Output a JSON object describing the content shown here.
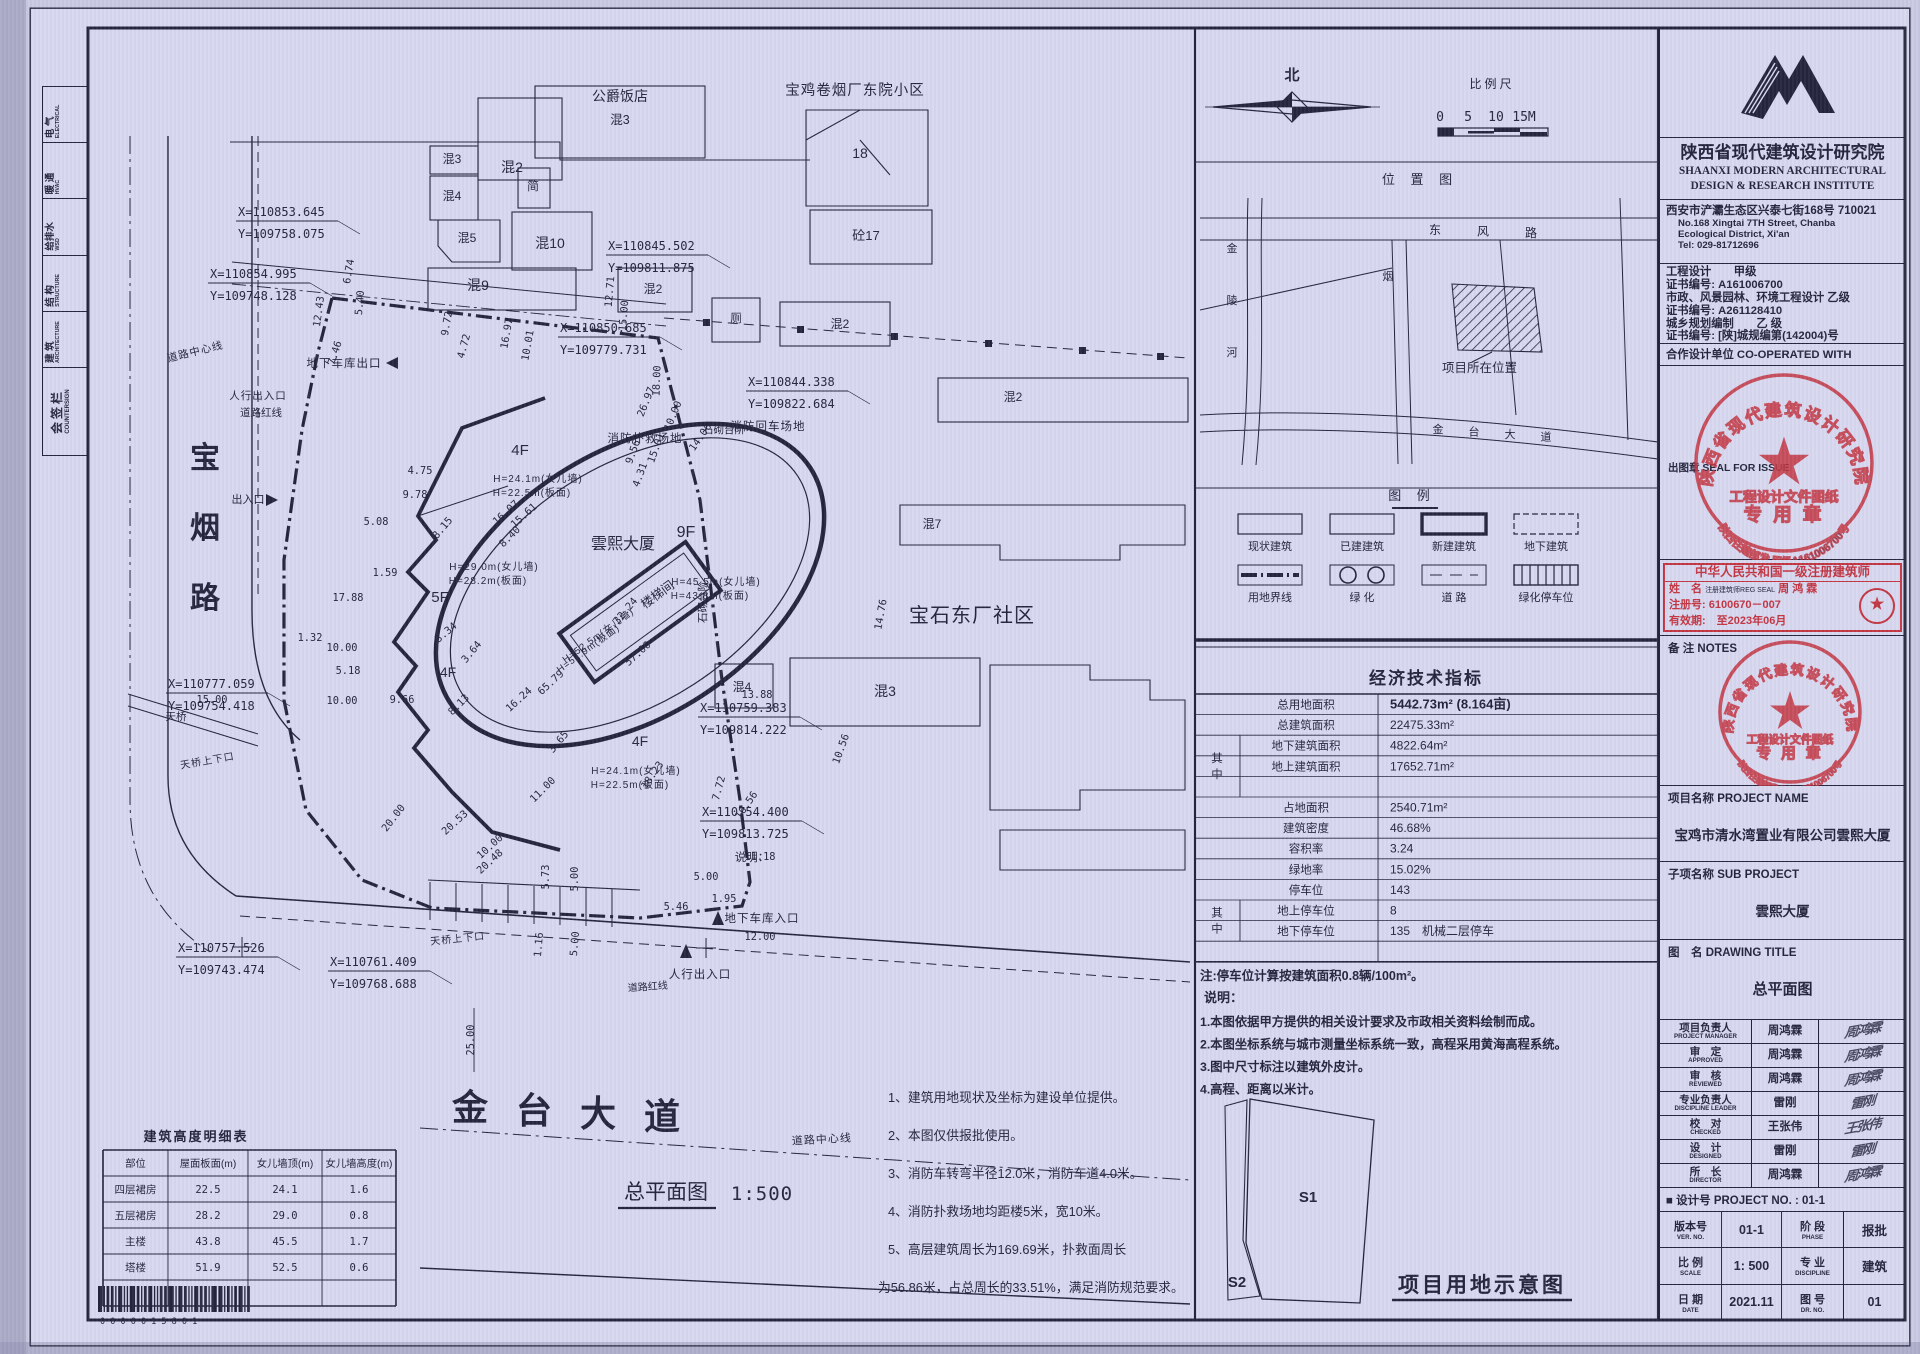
{
  "colors": {
    "paper": "#d7d7ef",
    "ink": "#23233a",
    "stamp_red": "#c23440"
  },
  "countersign": {
    "title_cn": "会签栏",
    "title_en": "COUNTERSIGN",
    "disciplines": [
      {
        "cn": "建 筑",
        "en": "ARCHITECTURE"
      },
      {
        "cn": "结 构",
        "en": "STRUCTURE"
      },
      {
        "cn": "给排水",
        "en": "WSD"
      },
      {
        "cn": "暖 通",
        "en": "HVAC"
      },
      {
        "cn": "电 气",
        "en": "ELECTRICAL"
      }
    ]
  },
  "site_plan": {
    "drawing_title": "总平面图",
    "drawing_scale": "1:500",
    "barcode": "0 0 0 0 0 1 5 8 0 1",
    "labels": [
      {
        "t": "公爵饭店",
        "x": 620,
        "y": 101,
        "s": 14
      },
      {
        "t": "混3",
        "x": 620,
        "y": 124,
        "s": 12.5
      },
      {
        "t": "宝鸡卷烟厂东院小区",
        "x": 855,
        "y": 95,
        "s": 14.5
      },
      {
        "t": "混3",
        "x": 452,
        "y": 163,
        "s": 12
      },
      {
        "t": "混2",
        "x": 512,
        "y": 172,
        "s": 14
      },
      {
        "t": "简",
        "x": 533,
        "y": 190,
        "s": 12
      },
      {
        "t": "混4",
        "x": 452,
        "y": 200,
        "s": 12
      },
      {
        "t": "混5",
        "x": 467,
        "y": 242,
        "s": 12
      },
      {
        "t": "混10",
        "x": 550,
        "y": 248,
        "s": 14
      },
      {
        "t": "混9",
        "x": 478,
        "y": 290,
        "s": 14
      },
      {
        "t": "混2",
        "x": 653,
        "y": 293,
        "s": 12
      },
      {
        "t": "18",
        "x": 860,
        "y": 158,
        "s": 14
      },
      {
        "t": "砼17",
        "x": 866,
        "y": 240,
        "s": 13
      },
      {
        "t": "厕",
        "x": 736,
        "y": 322,
        "s": 11.5
      },
      {
        "t": "混2",
        "x": 840,
        "y": 328,
        "s": 12
      },
      {
        "t": "混2",
        "x": 1013,
        "y": 401,
        "s": 12
      },
      {
        "t": "混7",
        "x": 932,
        "y": 528,
        "s": 12
      },
      {
        "t": "宝石东厂社区",
        "x": 972,
        "y": 622,
        "s": 20
      },
      {
        "t": "混3",
        "x": 885,
        "y": 696,
        "s": 14
      },
      {
        "t": "混4",
        "x": 742,
        "y": 691,
        "s": 12
      },
      {
        "t": "石砌台阶",
        "x": 724,
        "y": 433,
        "s": 10.5
      },
      {
        "t": "石砌台阶",
        "x": 706,
        "y": 602,
        "s": 10.5,
        "r": -90
      },
      {
        "t": "雲熙大厦",
        "x": 623,
        "y": 549,
        "s": 16
      },
      {
        "t": "9F",
        "x": 686,
        "y": 537,
        "s": 16
      },
      {
        "t": "4F",
        "x": 520,
        "y": 455,
        "s": 15
      },
      {
        "t": "5F",
        "x": 440,
        "y": 602,
        "s": 15
      },
      {
        "t": "4F",
        "x": 448,
        "y": 677,
        "s": 14
      },
      {
        "t": "4F",
        "x": 640,
        "y": 746,
        "s": 14
      },
      {
        "t": "楼梯间",
        "x": 660,
        "y": 598,
        "s": 12.5,
        "r": -36
      },
      {
        "t": "H=24.1m(女儿墙)",
        "x": 538,
        "y": 482,
        "s": 10
      },
      {
        "t": "H=22.5m(板面)",
        "x": 532,
        "y": 496,
        "s": 10
      },
      {
        "t": "H=29.0m(女儿墙)",
        "x": 494,
        "y": 570,
        "s": 10
      },
      {
        "t": "H=28.2m(板面)",
        "x": 488,
        "y": 584,
        "s": 10
      },
      {
        "t": "H=45.5m(女儿墙)",
        "x": 716,
        "y": 585,
        "s": 10
      },
      {
        "t": "H=43.8m(板面)",
        "x": 710,
        "y": 599,
        "s": 10
      },
      {
        "t": "H=52.5m(女儿墙)",
        "x": 600,
        "y": 638,
        "s": 9.5,
        "r": -36
      },
      {
        "t": "H=51.9m(板面)",
        "x": 590,
        "y": 651,
        "s": 9.5,
        "r": -36
      },
      {
        "t": "H=24.1m(女儿墙)",
        "x": 636,
        "y": 774,
        "s": 10
      },
      {
        "t": "H=22.5m(板面)",
        "x": 630,
        "y": 788,
        "s": 10
      },
      {
        "t": "消防扑救场地",
        "x": 645,
        "y": 442,
        "s": 11.5
      },
      {
        "t": "消防回车场地",
        "x": 768,
        "y": 430,
        "s": 11.5
      },
      {
        "t": "地下车库出口",
        "x": 344,
        "y": 367,
        "s": 11.5
      },
      {
        "t": "人行出入口",
        "x": 258,
        "y": 399,
        "s": 10.5
      },
      {
        "t": "道路红线",
        "x": 261,
        "y": 416,
        "s": 10.5
      },
      {
        "t": "道路中心线",
        "x": 196,
        "y": 355,
        "s": 10.5,
        "r": -14
      },
      {
        "t": "出入口",
        "x": 248,
        "y": 503,
        "s": 11
      },
      {
        "t": "宝",
        "x": 205,
        "y": 468,
        "s": 30,
        "b": 1
      },
      {
        "t": "烟",
        "x": 205,
        "y": 538,
        "s": 30,
        "b": 1
      },
      {
        "t": "路",
        "x": 205,
        "y": 608,
        "s": 30,
        "b": 1
      },
      {
        "t": "天桥",
        "x": 176,
        "y": 720,
        "s": 10.5
      },
      {
        "t": "天桥上下口",
        "x": 208,
        "y": 764,
        "s": 10,
        "r": -10
      },
      {
        "t": "天桥上下口",
        "x": 458,
        "y": 942,
        "s": 10,
        "r": -6
      },
      {
        "t": "道路红线",
        "x": 648,
        "y": 990,
        "s": 10,
        "r": -4
      },
      {
        "t": "道路中心线",
        "x": 822,
        "y": 1143,
        "s": 11,
        "r": -3
      },
      {
        "t": "人行出入口",
        "x": 700,
        "y": 978,
        "s": 11.5
      },
      {
        "t": "地下车库入口",
        "x": 762,
        "y": 922,
        "s": 11.5
      },
      {
        "t": "说明：",
        "x": 752,
        "y": 861,
        "s": 11.5
      },
      {
        "t": "金",
        "x": 470,
        "y": 1120,
        "s": 36,
        "b": 1
      },
      {
        "t": "台",
        "x": 534,
        "y": 1123,
        "s": 36,
        "b": 1
      },
      {
        "t": "大",
        "x": 598,
        "y": 1126,
        "s": 36,
        "b": 1
      },
      {
        "t": "道",
        "x": 662,
        "y": 1129,
        "s": 36,
        "b": 1
      },
      {
        "t": "总平面图",
        "x": 666,
        "y": 1199,
        "s": 21
      },
      {
        "t": "1:500",
        "x": 762,
        "y": 1200,
        "s": 19,
        "f": "m"
      }
    ],
    "dimensions": [
      {
        "t": "6.74",
        "x": 352,
        "y": 272,
        "r": -80
      },
      {
        "t": "5.40",
        "x": 363,
        "y": 303,
        "r": -85
      },
      {
        "t": "12.43",
        "x": 322,
        "y": 312,
        "r": -82
      },
      {
        "t": "7.46",
        "x": 338,
        "y": 354,
        "r": -72
      },
      {
        "t": "9.72",
        "x": 450,
        "y": 324,
        "r": -80
      },
      {
        "t": "4.72",
        "x": 467,
        "y": 347,
        "r": -75
      },
      {
        "t": "16.97",
        "x": 510,
        "y": 334,
        "r": -80
      },
      {
        "t": "10.01",
        "x": 531,
        "y": 346,
        "r": -80
      },
      {
        "t": "12.71",
        "x": 613,
        "y": 292,
        "r": -85
      },
      {
        "t": "15.00",
        "x": 627,
        "y": 316,
        "r": -85
      },
      {
        "t": "18.00",
        "x": 660,
        "y": 381,
        "r": -88
      },
      {
        "t": "26.97",
        "x": 649,
        "y": 403,
        "r": -68
      },
      {
        "t": "10.00",
        "x": 676,
        "y": 417,
        "r": -68
      },
      {
        "t": "14.06",
        "x": 703,
        "y": 439,
        "r": -55
      },
      {
        "t": "15.01",
        "x": 659,
        "y": 449,
        "r": -70
      },
      {
        "t": "9.56",
        "x": 636,
        "y": 453,
        "r": -70
      },
      {
        "t": "4.31",
        "x": 643,
        "y": 476,
        "r": -70
      },
      {
        "t": "4.75",
        "x": 420,
        "y": 474
      },
      {
        "t": "9.78",
        "x": 415,
        "y": 498
      },
      {
        "t": "5.08",
        "x": 376,
        "y": 525
      },
      {
        "t": "1.59",
        "x": 385,
        "y": 576
      },
      {
        "t": "17.88",
        "x": 348,
        "y": 601
      },
      {
        "t": "1.32",
        "x": 310,
        "y": 641
      },
      {
        "t": "10.00",
        "x": 342,
        "y": 651
      },
      {
        "t": "5.18",
        "x": 348,
        "y": 674
      },
      {
        "t": "10.00",
        "x": 342,
        "y": 704
      },
      {
        "t": "9.66",
        "x": 402,
        "y": 703
      },
      {
        "t": "15.00",
        "x": 212,
        "y": 703
      },
      {
        "t": "8.15",
        "x": 445,
        "y": 530,
        "r": -50
      },
      {
        "t": "16.07",
        "x": 508,
        "y": 515,
        "r": -42
      },
      {
        "t": "15.61",
        "x": 526,
        "y": 518,
        "r": -42
      },
      {
        "t": "8.40",
        "x": 512,
        "y": 539,
        "r": -45
      },
      {
        "t": "32.24",
        "x": 628,
        "y": 613,
        "r": -50
      },
      {
        "t": "57.00",
        "x": 640,
        "y": 656,
        "r": -42
      },
      {
        "t": "65.79",
        "x": 553,
        "y": 685,
        "r": -42
      },
      {
        "t": "8.13",
        "x": 461,
        "y": 707,
        "r": -45
      },
      {
        "t": "16.24",
        "x": 521,
        "y": 702,
        "r": -42
      },
      {
        "t": "3.65",
        "x": 561,
        "y": 744,
        "r": -50
      },
      {
        "t": "11.00",
        "x": 545,
        "y": 792,
        "r": -45
      },
      {
        "t": "3.34",
        "x": 448,
        "y": 635,
        "r": -40
      },
      {
        "t": "3.64",
        "x": 474,
        "y": 654,
        "r": -50
      },
      {
        "t": "20.00",
        "x": 396,
        "y": 820,
        "r": -52
      },
      {
        "t": "20.53",
        "x": 457,
        "y": 825,
        "r": -42
      },
      {
        "t": "10.00",
        "x": 492,
        "y": 849,
        "r": -42
      },
      {
        "t": "20.48",
        "x": 492,
        "y": 864,
        "r": -42
      },
      {
        "t": "5.73",
        "x": 549,
        "y": 877,
        "r": -90
      },
      {
        "t": "5.00",
        "x": 578,
        "y": 879,
        "r": -90
      },
      {
        "t": "1.16",
        "x": 542,
        "y": 945,
        "r": -85
      },
      {
        "t": "5.00",
        "x": 578,
        "y": 944,
        "r": -85
      },
      {
        "t": "18.23",
        "x": 655,
        "y": 777,
        "r": -55
      },
      {
        "t": "7.72",
        "x": 722,
        "y": 789,
        "r": -75
      },
      {
        "t": "16.56",
        "x": 749,
        "y": 807,
        "r": -55
      },
      {
        "t": "10.56",
        "x": 844,
        "y": 750,
        "r": -70
      },
      {
        "t": "14.76",
        "x": 884,
        "y": 615,
        "r": -80
      },
      {
        "t": "13.88",
        "x": 757,
        "y": 698
      },
      {
        "t": "11.18",
        "x": 760,
        "y": 860
      },
      {
        "t": "5.00",
        "x": 706,
        "y": 880
      },
      {
        "t": "1.95",
        "x": 724,
        "y": 902
      },
      {
        "t": "5.46",
        "x": 676,
        "y": 910
      },
      {
        "t": "12.00",
        "x": 760,
        "y": 940
      },
      {
        "t": "25.00",
        "x": 474,
        "y": 1040,
        "r": -90
      }
    ],
    "coordinates": [
      {
        "x": 238,
        "y": 216,
        "X": "X=110853.645",
        "Y": "Y=109758.075"
      },
      {
        "x": 210,
        "y": 278,
        "X": "X=110854.995",
        "Y": "Y=109748.128"
      },
      {
        "x": 560,
        "y": 332,
        "X": "X=110850.685",
        "Y": "Y=109779.731"
      },
      {
        "x": 608,
        "y": 250,
        "X": "X=110845.502",
        "Y": "Y=109811.875"
      },
      {
        "x": 748,
        "y": 386,
        "X": "X=110844.338",
        "Y": "Y=109822.684"
      },
      {
        "x": 168,
        "y": 688,
        "X": "X=110777.059",
        "Y": "Y=109754.418"
      },
      {
        "x": 178,
        "y": 952,
        "X": "X=110757.526",
        "Y": "Y=109743.474"
      },
      {
        "x": 330,
        "y": 966,
        "X": "X=110761.409",
        "Y": "Y=109768.688"
      },
      {
        "x": 700,
        "y": 712,
        "X": "X=110759.383",
        "Y": "Y=109814.222"
      },
      {
        "x": 702,
        "y": 816,
        "X": "X=110754.400",
        "Y": "Y=109813.725"
      }
    ],
    "notes": [
      "1、建筑用地现状及坐标为建设单位提供。",
      "2、本图仅供报批使用。",
      "3、消防车转弯半径12.0米，消防车道4.0米。",
      "4、消防扑救场地均距楼5米，宽10米。",
      "5、高层建筑周长为169.69米，扑救面周长",
      "为56.86米，占总周长的33.51%，满足消防规范要求。"
    ],
    "height_table": {
      "title": "建筑高度明细表",
      "headers": [
        "部位",
        "屋面板面(m)",
        "女儿墙顶(m)",
        "女儿墙高度(m)"
      ],
      "rows": [
        [
          "四层裙房",
          "22.5",
          "24.1",
          "1.6"
        ],
        [
          "五层裙房",
          "28.2",
          "29.0",
          "0.8"
        ],
        [
          "主楼",
          "43.8",
          "45.5",
          "1.7"
        ],
        [
          "塔楼",
          "51.9",
          "52.5",
          "0.6"
        ],
        [
          "",
          "",
          "",
          ""
        ]
      ]
    }
  },
  "middle": {
    "north_label": "北",
    "scale_bar": {
      "title": "比例尺",
      "ticks": [
        "0",
        "5",
        "10",
        "15M"
      ]
    },
    "location_map": {
      "title": "位 置 图",
      "marker_label": "项目所在位置",
      "roads": {
        "dongfeng": [
          "东",
          "风",
          "路"
        ],
        "jinling": [
          "金",
          "陵",
          "河"
        ],
        "yan": "烟",
        "jintai": [
          "金",
          "台",
          "大",
          "道"
        ]
      }
    },
    "legend": {
      "title": "图 例",
      "items": [
        {
          "label": "现状建筑",
          "sym": "box-thin"
        },
        {
          "label": "已建建筑",
          "sym": "box-thin"
        },
        {
          "label": "新建建筑",
          "sym": "box-thick"
        },
        {
          "label": "地下建筑",
          "sym": "box-dash"
        },
        {
          "label": "用地界线",
          "sym": "dashdot"
        },
        {
          "label": "绿 化",
          "sym": "circles"
        },
        {
          "label": "道 路",
          "sym": "road"
        },
        {
          "label": "绿化停车位",
          "sym": "hatch"
        }
      ]
    },
    "economic": {
      "title": "经济技术指标",
      "among_label": "其中",
      "rows": [
        {
          "label": "总用地面积",
          "value": "5442.73m² (8.164亩)",
          "strong": 1
        },
        {
          "label": "总建筑面积",
          "value": "22475.33m²"
        },
        {
          "label": "地下建筑面积",
          "value": "4822.64m²",
          "group": 1,
          "span": 3
        },
        {
          "label": "地上建筑面积",
          "value": "17652.71m²"
        },
        {
          "label": "",
          "value": ""
        },
        {
          "label": "占地面积",
          "value": "2540.71m²"
        },
        {
          "label": "建筑密度",
          "value": "46.68%"
        },
        {
          "label": "容积率",
          "value": "3.24"
        },
        {
          "label": "绿地率",
          "value": "15.02%"
        },
        {
          "label": "停车位",
          "value": "143"
        },
        {
          "label": "地上停车位",
          "value": "8",
          "group": 1,
          "span": 2
        },
        {
          "label": "地下停车位",
          "value": "135　机械二层停车"
        },
        {
          "label": "",
          "value": ""
        }
      ]
    },
    "parking_note": "注:停车位计算按建筑面积0.8辆/100m²。",
    "notes_title": "说明：",
    "notes": [
      "1.本图依据甲方提供的相关设计要求及市政相关资料绘制而成。",
      "2.本图坐标系统与城市测量坐标系统一致，高程采用黄海高程系统。",
      "3.图中尺寸标注以建筑外皮计。",
      "4.高程、距离以米计。"
    ],
    "land_diagram": {
      "s1": "S1",
      "s2": "S2",
      "title": "项目用地示意图"
    }
  },
  "title_block": {
    "company_cn": "陕西省现代建筑设计研究院",
    "company_en1": "SHAANXI MODERN ARCHITECTURAL",
    "company_en2": "DESIGN & RESEARCH INSTITUTE",
    "address_cn": "西安市浐灞生态区兴泰七街168号  710021",
    "address_en1": "No.168 Xingtai 7TH Street, Chanba",
    "address_en2": "Ecological District, Xi'an",
    "tel": "Tel: 029-81712696",
    "qualifications": [
      "工程设计　　甲级",
      "证书编号: A161006700",
      "市政、风景园林、环境工程设计 乙级",
      "证书编号: A261128410",
      "城乡规划编制　　乙 级",
      "证书编号: [陕]城规编第(142004)号"
    ],
    "cooperate": "合作设计单位 CO-OPERATED WITH",
    "issue_seal_label": "出图章 SEAL FOR ISSUE",
    "stamp": {
      "ring_top": "陕西省现代建筑设计研究院",
      "line1": "工程设计文件图纸",
      "line2": "专 用 章",
      "ring_bottom": "陕西住建部发 甲级A161006700号"
    },
    "architect_box": {
      "header": "中华人民共和国一级注册建筑师",
      "name_label": "姓　名",
      "seal_text": "注册建筑师REG SEAL",
      "name": "周 鸿 霖",
      "reg_line": "注册号: 6100670－007",
      "valid_line": "有效期:　至2023年06月",
      "emblem": "★"
    },
    "notes_label": "备 注 NOTES",
    "project_name_label": "项目名称 PROJECT NAME",
    "project_name": "宝鸡市清水湾置业有限公司雲熙大厦",
    "sub_project_label": "子项名称 SUB PROJECT",
    "sub_project": "雲熙大厦",
    "drawing_title_label": "图　名 DRAWING TITLE",
    "drawing_title": "总平面图",
    "signatures": [
      {
        "cn": "项目负责人",
        "en": "PROJECT MANAGER",
        "name": "周鸿霖"
      },
      {
        "cn": "审　定",
        "en": "APPROVED",
        "name": "周鸿霖"
      },
      {
        "cn": "审　核",
        "en": "REVIEWED",
        "name": "周鸿霖"
      },
      {
        "cn": "专业负责人",
        "en": "DISCIPLINE LEADER",
        "name": "雷刚"
      },
      {
        "cn": "校　对",
        "en": "CHECKED",
        "name": "王张伟"
      },
      {
        "cn": "设　计",
        "en": "DESIGNED",
        "name": "雷刚"
      },
      {
        "cn": "所　长",
        "en": "DIRECTOR",
        "name": "周鸿霖"
      }
    ],
    "project_no_label": "■ 设计号 PROJECT NO. : ",
    "project_no": "01-1",
    "grid": [
      {
        "cn": "版本号",
        "en": "VER. NO.",
        "v": "01-1",
        "cn2": "阶 段",
        "en2": "PHASE",
        "v2": "报批"
      },
      {
        "cn": "比 例",
        "en": "SCALE",
        "v": "1: 500",
        "cn2": "专 业",
        "en2": "DISCIPLINE",
        "v2": "建筑"
      },
      {
        "cn": "日 期",
        "en": "DATE",
        "v": "2021.11",
        "cn2": "图 号",
        "en2": "DR. NO.",
        "v2": "01"
      }
    ]
  }
}
